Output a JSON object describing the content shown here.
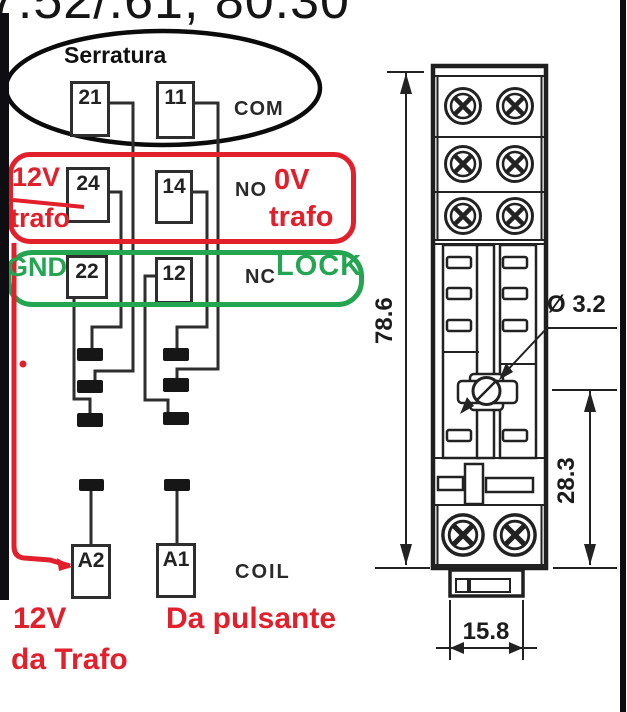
{
  "title": "7.52/.61, 80.30",
  "colors": {
    "red": "#e1202b",
    "green": "#23a551",
    "line": "#2e2e2e"
  },
  "schematic": {
    "ellipse_label": "Serratura",
    "pins": {
      "p21": "21",
      "p11": "11",
      "p24": "24",
      "p14": "14",
      "p22": "22",
      "p12": "12",
      "a2": "A2",
      "a1": "A1"
    },
    "row_labels": {
      "com": "COM",
      "no": "NO",
      "nc": "NC",
      "coil": "COIL"
    },
    "annotations": {
      "red_left_line1": "12V",
      "red_left_line2": "trafo",
      "red_right_line1": "0V",
      "red_right_line2": "trafo",
      "green_left": "GND",
      "green_right": "LOCK",
      "coil_left_line1": "12V",
      "coil_left_line2": "da Trafo",
      "coil_right": "Da pulsante"
    }
  },
  "drawing": {
    "dim_height": "78.6",
    "dim_hole": "Ø 3.2",
    "dim_lower": "28.3",
    "dim_width": "15.8"
  }
}
